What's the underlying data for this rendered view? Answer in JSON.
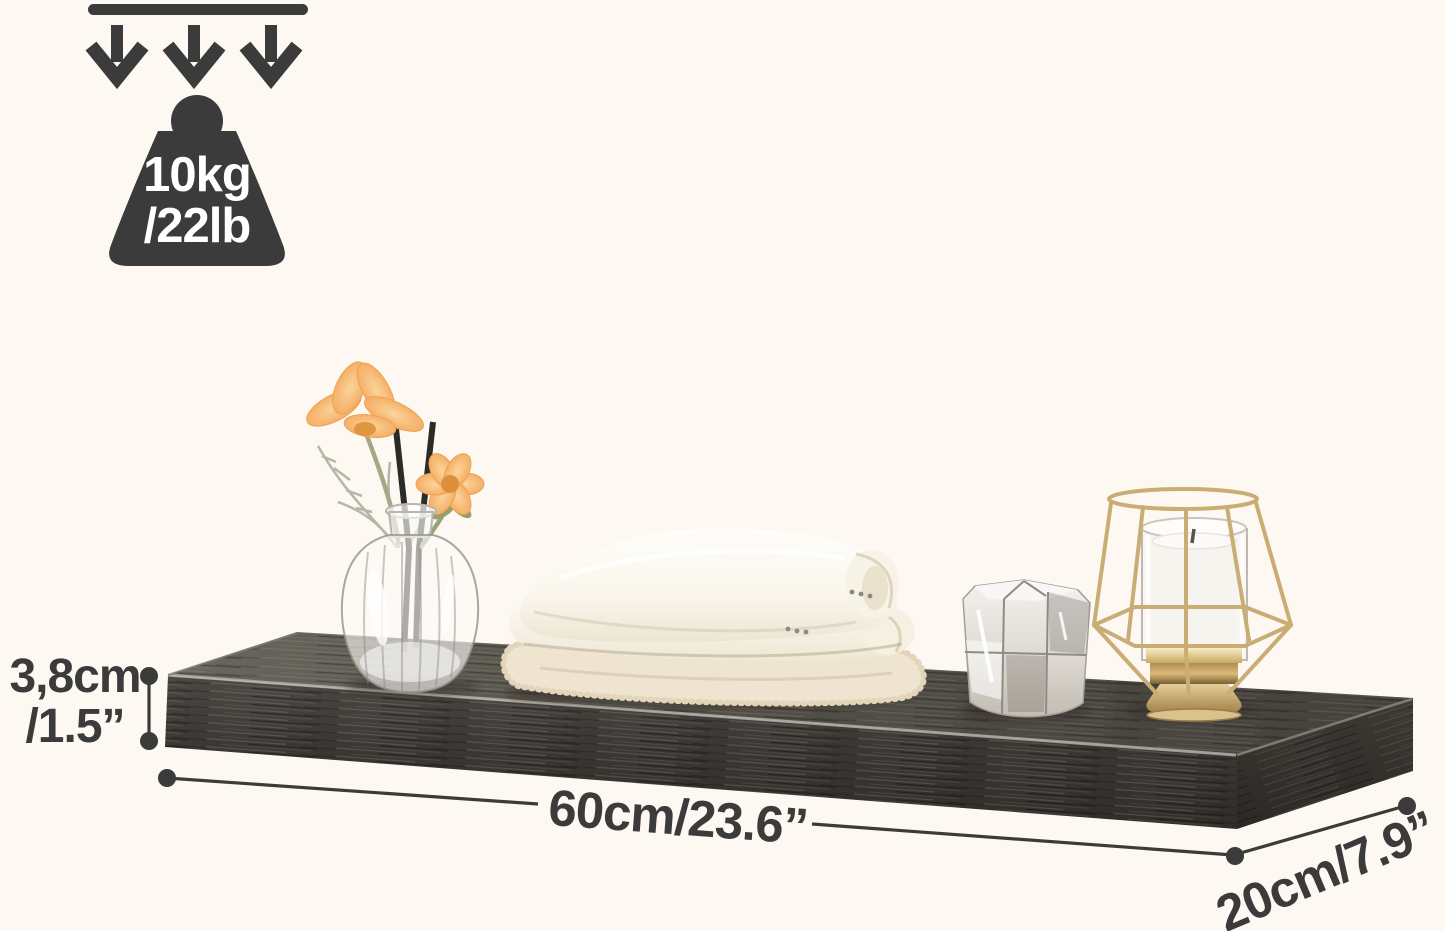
{
  "image": {
    "background_color": "#fdf8f1",
    "annotation_color": "#3b3b3b"
  },
  "weight_capacity": {
    "icon": "weight-with-down-arrows-icon",
    "kg_label": "10kg",
    "lb_label": "/22lb",
    "text_color": "#ffffff"
  },
  "dimensions": {
    "height": {
      "metric": "3,8cm",
      "imperial": "/1.5”"
    },
    "length": {
      "label": "60cm/23.6”"
    },
    "depth": {
      "label": "20cm/7.9”"
    }
  },
  "shelf": {
    "label": "charcoal woodgrain floating wall shelf",
    "top_color": "#56534e",
    "front_color": "#3b3835",
    "side_color": "#322f2b",
    "edge_highlight": "#b3afa7"
  },
  "decor": {
    "vase": "glass bud vase with orange flowers and black diffuser reeds",
    "towels": "stack of three folded towels",
    "crystal_holder": "faceted crystal tealight holder",
    "lantern": "gold wire candle lantern with white pillar candle",
    "flower_color": "#f3a95c",
    "gold_color": "#c9ad74"
  }
}
